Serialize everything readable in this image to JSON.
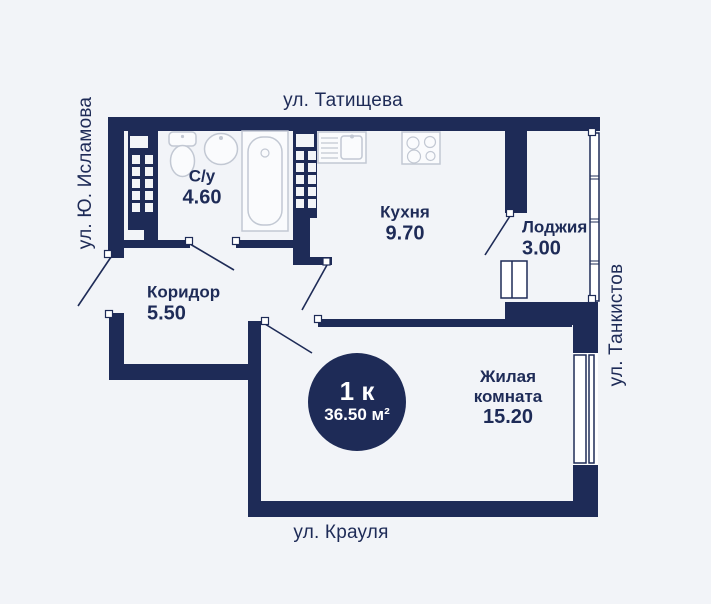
{
  "plan": {
    "streets": {
      "top": "ул. Татищева",
      "left": "ул. Ю. Исламова",
      "right": "ул. Танкистов",
      "bottom": "ул. Крауля"
    },
    "rooms": {
      "bathroom": {
        "name": "С/у",
        "area": "4.60"
      },
      "kitchen": {
        "name": "Кухня",
        "area": "9.70"
      },
      "loggia": {
        "name": "Лоджия",
        "area": "3.00"
      },
      "corridor": {
        "name": "Коридор",
        "area": "5.50"
      },
      "living": {
        "name": "Жилая комната",
        "area": "15.20"
      }
    },
    "badge": {
      "rooms": "1 к",
      "area": "36.50 м²"
    },
    "colors": {
      "wall": "#1e2b57",
      "background": "#f2f4f8",
      "fixture": "#c2c8d3"
    }
  }
}
